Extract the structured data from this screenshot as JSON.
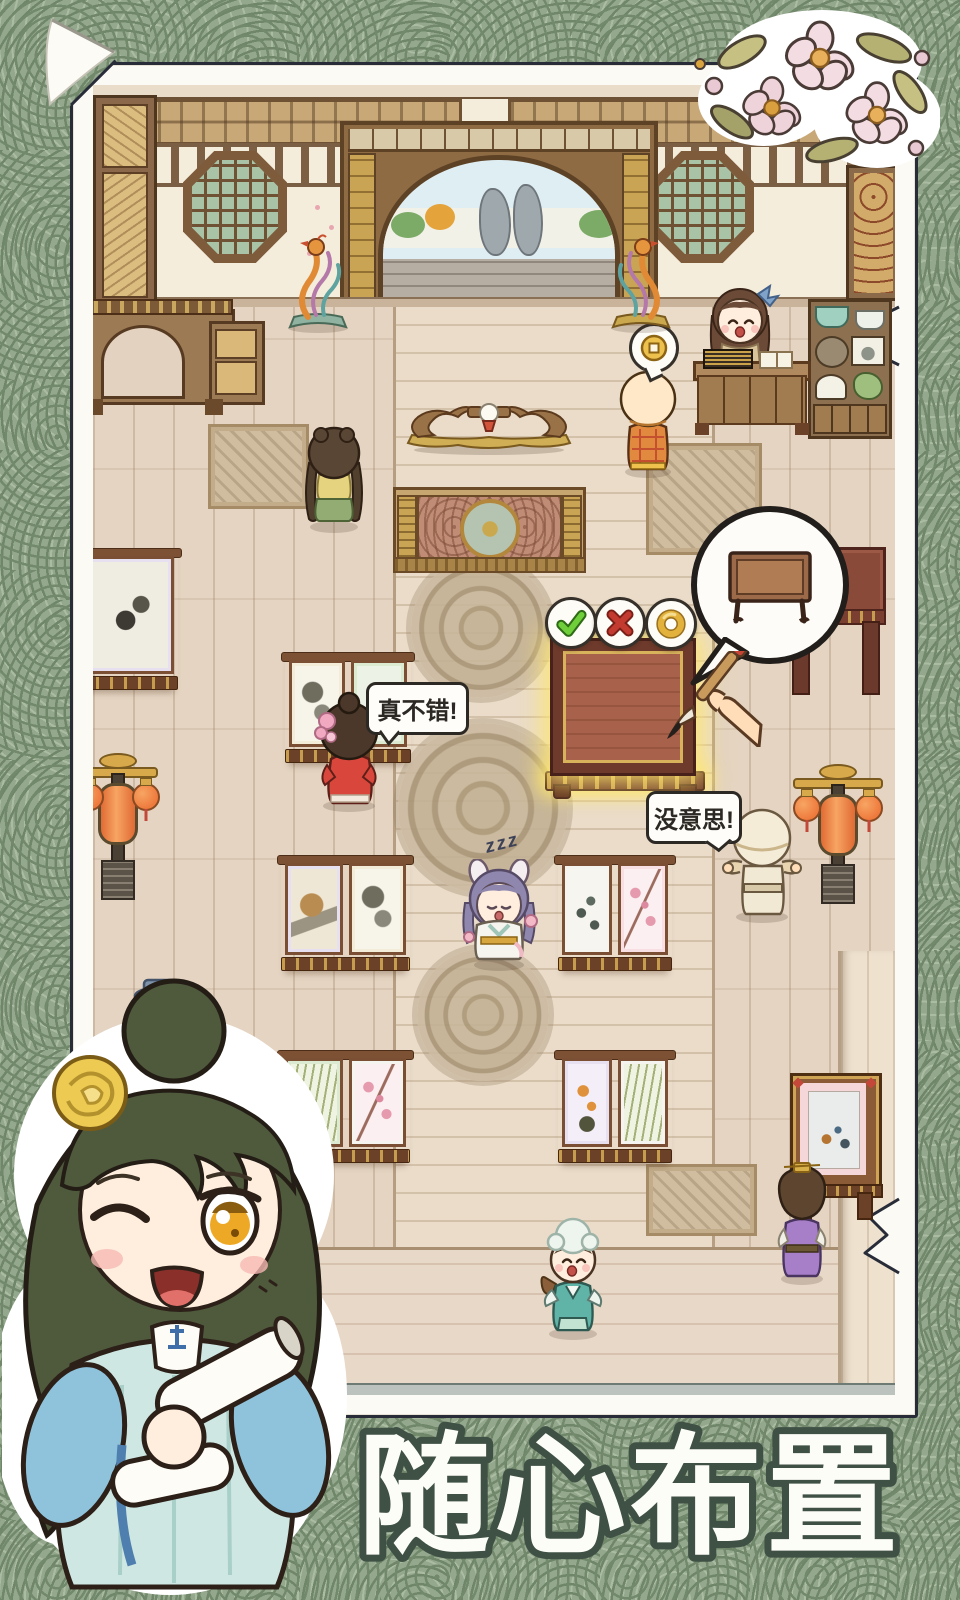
{
  "caption": "随心布置",
  "bubbles": {
    "praise": "真不错!",
    "boring": "没意思!",
    "sleep": "zzz"
  },
  "placement_toolbar": {
    "buttons": [
      {
        "name": "confirm",
        "icon": "check-icon",
        "color": "#5fbe33"
      },
      {
        "name": "cancel",
        "icon": "x-icon",
        "color": "#c73c31"
      },
      {
        "name": "cost",
        "icon": "coin-ring-icon",
        "color": "#e3b23e"
      }
    ]
  },
  "thought_bubble": {
    "icon": "table-icon"
  },
  "coin_bubble": {
    "icon": "copper-coin-icon",
    "color": "#ecc14e"
  },
  "colors": {
    "background_green": "#94a88d",
    "pattern_ring": "#72896c",
    "card_white": "#fbfaf4",
    "card_outline": "#272c38",
    "placement_glow": "#ffe76e",
    "caption_fill": "#fdfdf8",
    "caption_outline": "#3f5045"
  }
}
